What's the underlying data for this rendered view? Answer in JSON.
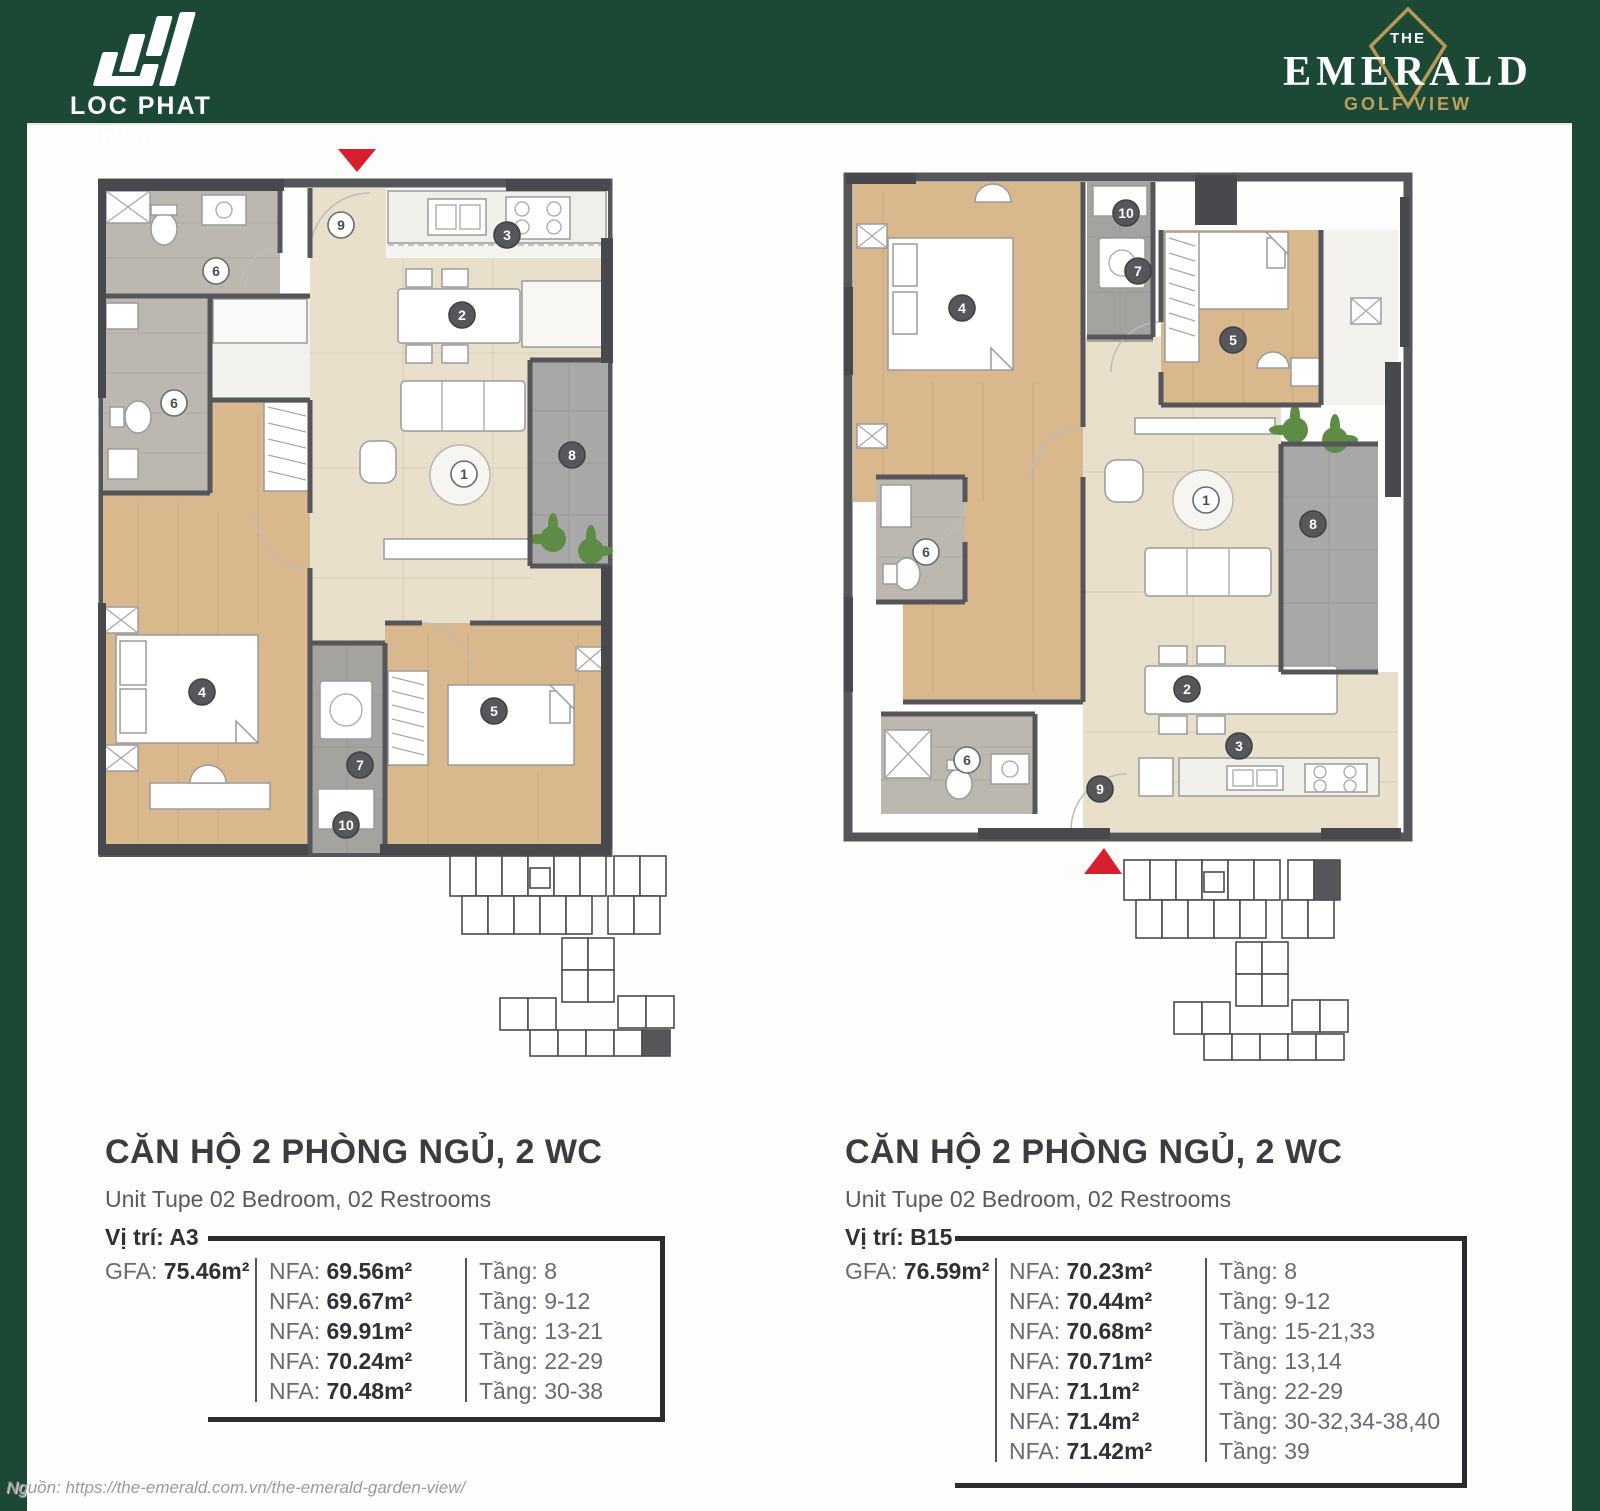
{
  "page": {
    "background_color": "#1c4936",
    "accent_red": "#d6202f",
    "source_note": "Nguồn: https://the-emerald.com.vn/the-emerald-garden-view/"
  },
  "header": {
    "developer": {
      "name": "LOC PHAT HUNG"
    },
    "project": {
      "the": "THE",
      "name": "EMERALD",
      "tagline": "GOLF VIEW",
      "gold": "#bda05e"
    }
  },
  "units": [
    {
      "title": "CĂN HỘ 2 PHÒNG NGỦ, 2 WC",
      "subtitle": "Unit Tupe 02 Bedroom, 02 Restrooms",
      "location": "Vị trí: A3",
      "gfa": {
        "label": "GFA:",
        "value": "75.46m²"
      },
      "nfa_rows": [
        {
          "label": "NFA:",
          "value": "69.56m²",
          "floor": "Tầng: 8"
        },
        {
          "label": "NFA:",
          "value": "69.67m²",
          "floor": "Tầng: 9-12"
        },
        {
          "label": "NFA:",
          "value": "69.91m²",
          "floor": "Tầng: 13-21"
        },
        {
          "label": "NFA:",
          "value": "70.24m²",
          "floor": "Tầng: 22-29"
        },
        {
          "label": "NFA:",
          "value": "70.48m²",
          "floor": "Tầng: 30-38"
        }
      ],
      "markers": [
        {
          "n": "9",
          "x": 243,
          "y": 42,
          "dark": false
        },
        {
          "n": "3",
          "x": 409,
          "y": 52,
          "dark": true
        },
        {
          "n": "2",
          "x": 364,
          "y": 132,
          "dark": true
        },
        {
          "n": "1",
          "x": 366,
          "y": 291,
          "dark": false
        },
        {
          "n": "6",
          "x": 118,
          "y": 88,
          "dark": false
        },
        {
          "n": "6",
          "x": 76,
          "y": 220,
          "dark": false
        },
        {
          "n": "8",
          "x": 474,
          "y": 272,
          "dark": true
        },
        {
          "n": "4",
          "x": 104,
          "y": 509,
          "dark": true
        },
        {
          "n": "5",
          "x": 396,
          "y": 528,
          "dark": true
        },
        {
          "n": "7",
          "x": 262,
          "y": 582,
          "dark": true
        },
        {
          "n": "10",
          "x": 248,
          "y": 642,
          "dark": true
        }
      ]
    },
    {
      "title": "CĂN HỘ 2 PHÒNG NGỦ, 2 WC",
      "subtitle": "Unit Tupe 02 Bedroom, 02 Restrooms",
      "location": "Vị trí: B15",
      "gfa": {
        "label": "GFA:",
        "value": "76.59m²"
      },
      "nfa_rows": [
        {
          "label": "NFA:",
          "value": "70.23m²",
          "floor": "Tầng: 8"
        },
        {
          "label": "NFA:",
          "value": "70.44m²",
          "floor": "Tầng: 9-12"
        },
        {
          "label": "NFA:",
          "value": "70.68m²",
          "floor": "Tầng: 15-21,33"
        },
        {
          "label": "NFA:",
          "value": "70.71m²",
          "floor": "Tầng: 13,14"
        },
        {
          "label": "NFA:",
          "value": "71.1m²",
          "floor": "Tầng: 22-29"
        },
        {
          "label": "NFA:",
          "value": "71.4m²",
          "floor": "Tầng: 30-32,34-38,40"
        },
        {
          "label": "NFA:",
          "value": "71.42m²",
          "floor": "Tầng: 39"
        }
      ],
      "markers": [
        {
          "n": "10",
          "x": 283,
          "y": 41,
          "dark": true
        },
        {
          "n": "7",
          "x": 295,
          "y": 99,
          "dark": true
        },
        {
          "n": "4",
          "x": 119,
          "y": 136,
          "dark": true
        },
        {
          "n": "5",
          "x": 390,
          "y": 168,
          "dark": true
        },
        {
          "n": "6",
          "x": 83,
          "y": 380,
          "dark": false
        },
        {
          "n": "1",
          "x": 363,
          "y": 328,
          "dark": false
        },
        {
          "n": "8",
          "x": 470,
          "y": 352,
          "dark": true
        },
        {
          "n": "6",
          "x": 124,
          "y": 588,
          "dark": false
        },
        {
          "n": "2",
          "x": 344,
          "y": 517,
          "dark": true
        },
        {
          "n": "3",
          "x": 396,
          "y": 574,
          "dark": true
        },
        {
          "n": "9",
          "x": 257,
          "y": 617,
          "dark": true
        }
      ]
    }
  ]
}
